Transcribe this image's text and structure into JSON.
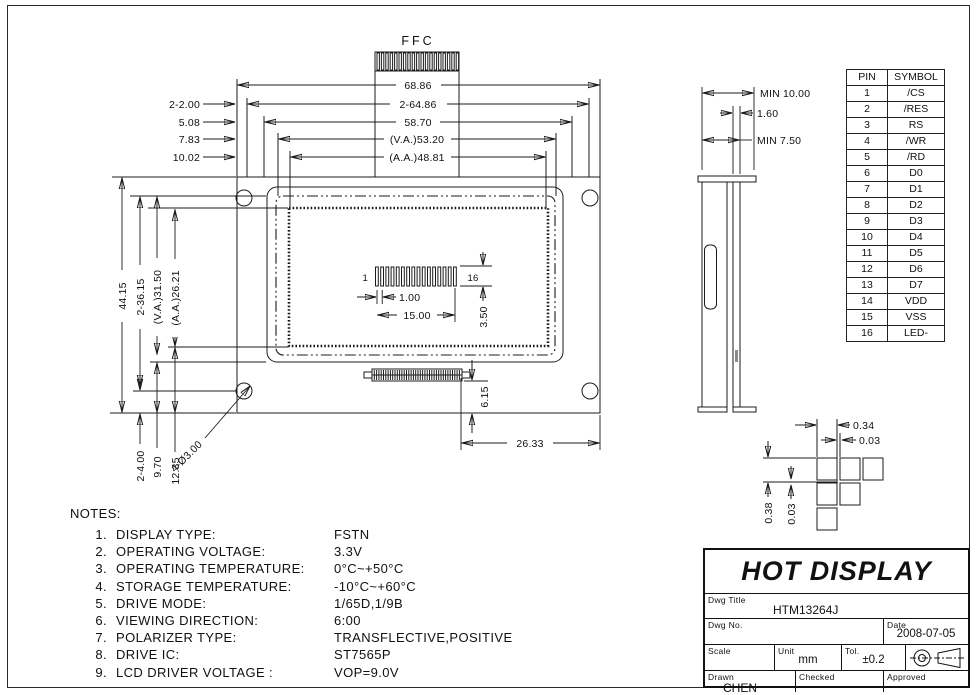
{
  "front_view": {
    "ffc_label": "FFC",
    "dims": {
      "top": [
        "68.86",
        "2-64.86",
        "58.70",
        "(V.A.)53.20",
        "(A.A.)48.81"
      ],
      "top_left": [
        "2-2.00",
        "5.08",
        "7.83",
        "10.02"
      ],
      "left": [
        "44.15",
        "2-36.15",
        "(V.A.)31.50",
        "(A.A.)26.21"
      ],
      "bottom_left": [
        "2-4.00",
        "9.70",
        "12.35"
      ],
      "hole_callout": "4-Ø3.00",
      "pin_first": "1",
      "pin_last": "16",
      "pin_pitch": "1.00",
      "pin_span": "15.00",
      "pin_height": "3.50",
      "tail_offset": "6.15",
      "tail_right": "26.33"
    }
  },
  "side_view": {
    "dims": [
      "MIN 10.00",
      "1.60",
      "MIN 7.50"
    ]
  },
  "dot_detail": {
    "pitch_x": "0.34",
    "gap_x": "0.03",
    "pitch_y": "0.38",
    "gap_y": "0.03"
  },
  "pin_table": {
    "headers": [
      "PIN",
      "SYMBOL"
    ],
    "rows": [
      [
        "1",
        "/CS"
      ],
      [
        "2",
        "/RES"
      ],
      [
        "3",
        "RS"
      ],
      [
        "4",
        "/WR"
      ],
      [
        "5",
        "/RD"
      ],
      [
        "6",
        "D0"
      ],
      [
        "7",
        "D1"
      ],
      [
        "8",
        "D2"
      ],
      [
        "9",
        "D3"
      ],
      [
        "10",
        "D4"
      ],
      [
        "11",
        "D5"
      ],
      [
        "12",
        "D6"
      ],
      [
        "13",
        "D7"
      ],
      [
        "14",
        "VDD"
      ],
      [
        "15",
        "VSS"
      ],
      [
        "16",
        "LED-"
      ]
    ]
  },
  "notes": {
    "title": "NOTES:",
    "items": [
      {
        "no": "1.",
        "label": "DISPLAY TYPE:",
        "value": "FSTN"
      },
      {
        "no": "2.",
        "label": "OPERATING VOLTAGE:",
        "value": "3.3V"
      },
      {
        "no": "3.",
        "label": "OPERATING TEMPERATURE:",
        "value": "0°C~+50°C"
      },
      {
        "no": "4.",
        "label": "STORAGE TEMPERATURE:",
        "value": "-10°C~+60°C"
      },
      {
        "no": "5.",
        "label": "DRIVE MODE:",
        "value": "1/65D,1/9B"
      },
      {
        "no": "6.",
        "label": "VIEWING DIRECTION:",
        "value": "6:00"
      },
      {
        "no": "7.",
        "label": "POLARIZER TYPE:",
        "value": "TRANSFLECTIVE,POSITIVE"
      },
      {
        "no": "8.",
        "label": "DRIVE IC:",
        "value": "ST7565P"
      },
      {
        "no": "9.",
        "label": "LCD DRIVER VOLTAGE :",
        "value": "VOP=9.0V"
      }
    ]
  },
  "title_block": {
    "company": "HOT DISPLAY",
    "dwg_title_label": "Dwg Title",
    "dwg_title": "HTM13264J",
    "dwg_no_label": "Dwg No.",
    "date_label": "Date",
    "date": "2008-07-05",
    "scale_label": "Scale",
    "unit_label": "Unit",
    "unit": "mm",
    "tol_label": "Tol.",
    "tol": "±0.2",
    "drawn_label": "Drawn",
    "drawn": "CHEN",
    "checked_label": "Checked",
    "approved_label": "Approved"
  }
}
